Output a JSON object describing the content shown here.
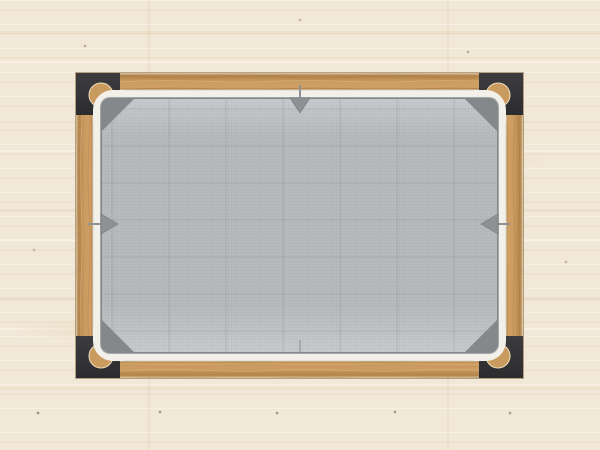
{
  "meta": {
    "width": 600,
    "height": 450,
    "description": "Top-down render of a rectangular timber pergola frame with black corner brackets and round post tops, a gray canvas stretched inside with white edge trim, shown on a pale wood plank floor; gray arrow handles point inward at the middle of each edge"
  },
  "colors": {
    "floor_base": "#f2e8d8",
    "floor_speck": "#6f5c44",
    "wood_base": "#c99b5f",
    "wood_dark": "#b2834a",
    "wood_light": "#d0a065",
    "wood_pale": "#dcc8a4",
    "wood_inner_dark": "#a97c41",
    "wood_outline": "#8f6a38",
    "bracket_black": "#2c2c2e",
    "bracket_light": "#3c3c3e",
    "post_wood": "#c99b5f",
    "post_rim": "#eddcbb",
    "trim_white": "#f2f0e9",
    "trim_edge": "#d9d4c6",
    "keder_gray": "#a4a8aa",
    "shadow_gray": "#84888b",
    "fabric_base": "#b6b9bb",
    "fabric_light": "#c6c9cb",
    "handle_gray": "#8d9193",
    "handle_dark": "#7a7e81",
    "handle_faint": "#9aa0a2"
  },
  "scene": {
    "floor": {
      "label": "wood plank floor"
    },
    "frame": {
      "label": "timber frame",
      "beams": [
        "top",
        "right",
        "bottom",
        "left"
      ],
      "corner_brackets": [
        "top-left",
        "top-right",
        "bottom-left",
        "bottom-right"
      ],
      "posts": 4
    },
    "canopy": {
      "label": "gray canvas cover",
      "trim": "white edge trim",
      "corner_pockets": 4
    },
    "handles": [
      {
        "id": "top",
        "icon": "arrow-down",
        "position": "top-center"
      },
      {
        "id": "left",
        "icon": "arrow-right",
        "position": "left-center"
      },
      {
        "id": "right",
        "icon": "arrow-left",
        "position": "right-center"
      },
      {
        "id": "bottom",
        "icon": "pin",
        "position": "bottom-center"
      }
    ]
  }
}
